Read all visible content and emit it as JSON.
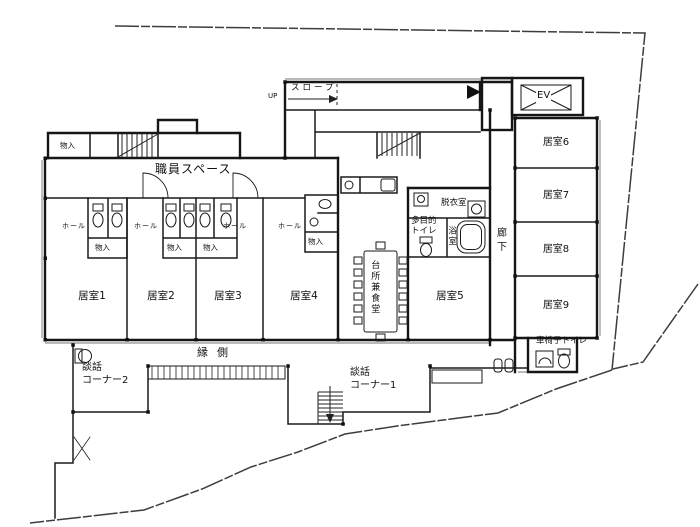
{
  "colors": {
    "paper": "#ffffff",
    "wall_line": "#161616",
    "boundary_line": "#3d3d3d"
  },
  "labels": {
    "up": "UP",
    "slope": "スロープ",
    "ev": "EV",
    "staff_space": "職員スペース",
    "corridor": "廊下",
    "veranda": "縁側",
    "kitchen_dining": "台所兼食堂",
    "dressing_room": "脱衣室",
    "multipurpose_toilet_line1": "多目的",
    "multipurpose_toilet_line2": "トイレ",
    "bath": "浴室",
    "wheelchair_toilet": "車椅子トイレ",
    "chat_corner1_line1": "談話",
    "chat_corner1_line2": "コーナー1",
    "chat_corner2_line1": "談話",
    "chat_corner2_line2": "コーナー2",
    "storage": "物入",
    "hall": "ホール"
  },
  "rooms": {
    "room1": "居室1",
    "room2": "居室2",
    "room3": "居室3",
    "room4": "居室4",
    "room5": "居室5",
    "room6": "居室6",
    "room7": "居室7",
    "room8": "居室8",
    "room9": "居室9"
  }
}
